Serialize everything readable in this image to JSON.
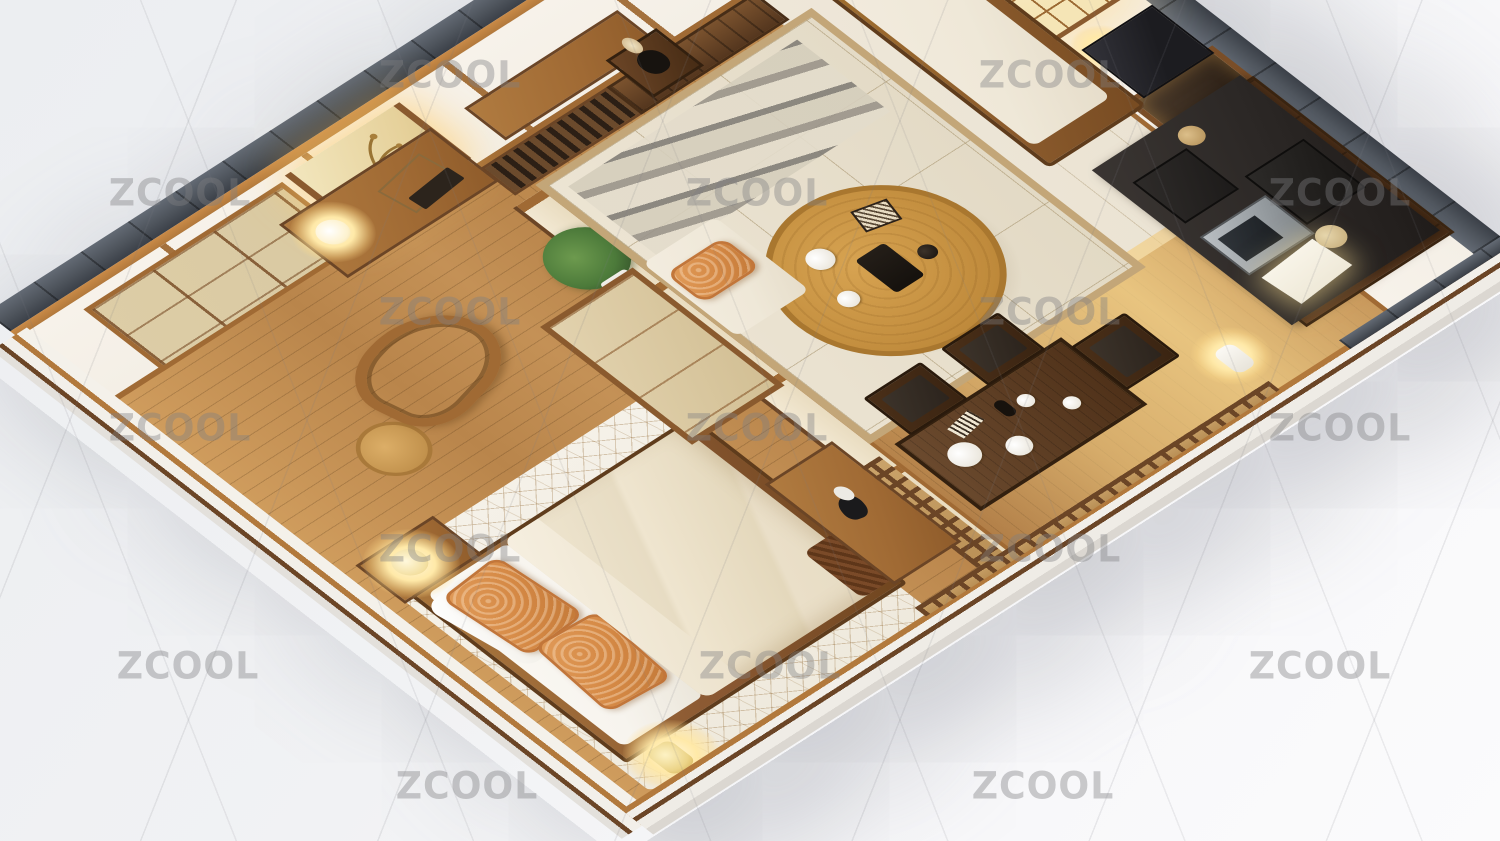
{
  "image": {
    "subject": "3d-isometric-dollhouse-render-of-japanese-style-apartment",
    "view": "cutaway top-down isometric, roof removed, white studio backdrop"
  },
  "watermark": {
    "text": "ZCOOL",
    "color": "rgba(128,128,131,0.40)",
    "positions": [
      [
        450,
        75
      ],
      [
        1050,
        75
      ],
      [
        180,
        193
      ],
      [
        757,
        193
      ],
      [
        1340,
        193
      ],
      [
        450,
        312
      ],
      [
        1050,
        312
      ],
      [
        180,
        428
      ],
      [
        757,
        428
      ],
      [
        1340,
        428
      ],
      [
        450,
        549
      ],
      [
        1050,
        549
      ],
      [
        188,
        666
      ],
      [
        770,
        666
      ],
      [
        1320,
        666
      ],
      [
        467,
        786
      ],
      [
        1043,
        786
      ]
    ]
  },
  "palette": {
    "slate": "#4e545c",
    "slate-dark": "#3b4048",
    "slate-light": "#636a74",
    "wood-cap": "#b2793c",
    "wood-frame": "#a06a34",
    "wood-dark": "#6b4526",
    "wood-deep": "#54361e",
    "walnut": "#4f3119",
    "wood-floor-light": "#cf9c5d",
    "wood-floor": "#b9854b",
    "wood-floor-dark": "#8a5f36",
    "shoji": "#f4efe6",
    "shoji-warm": "#e9dcc0",
    "shoji-tan": "#d9c9a2",
    "tatami": "#e9e1d0",
    "tatami-border": "#c3a678",
    "cream": "#efe8d8",
    "white-soft": "#f7f4ee",
    "duvet": "#eadfc8",
    "pillow-orange": "#d58945",
    "counter-top": "#2c2826",
    "appliance-black": "#1d1b1a",
    "appliance-silver": "#9aa0a4",
    "glow": "#ffe9a8",
    "glow-core": "#fff6d9",
    "green": "#4c7a3a",
    "watermark": "rgba(128,128,131,0.40)"
  },
  "scene": {
    "rooms": [
      {
        "name": "bedroom",
        "items": [
          "double-bed",
          "white-sheets",
          "cream-duvet",
          "two-orange-textured-pillows",
          "crackle-pattern-rug",
          "nightstand-with-glowing-lamp",
          "round-wood-stool",
          "curved-valet-chair",
          "foot-bench-with-bird-figurine",
          "brown-blanket",
          "yellow-floor-lamp"
        ]
      },
      {
        "name": "study-nook",
        "items": [
          "hanging-scroll-painting",
          "console-table",
          "glowing-ball-lamp",
          "books",
          "shoji-closet-doors"
        ]
      },
      {
        "name": "entry",
        "items": [
          "slatted-wood-partition",
          "plank-partition",
          "low-bench",
          "vase-stand-with-dried-branch",
          "console-with-white-towels",
          "two-pendant-lanterns",
          "dark-wall-clock",
          "potted-green-plant"
        ]
      },
      {
        "name": "living",
        "items": [
          "tatami-platform",
          "gray-striped-runner",
          "round-wood-tea-table",
          "tea-tray-and-dishes",
          "floor-cushion-with-orange-bolster",
          "wood-frame-daybed-sofa",
          "beige-pillow",
          "shoji-window-glowing"
        ]
      },
      {
        "name": "kitchen",
        "items": [
          "dark-top-wood-counter",
          "microwave",
          "black-coffee-machine",
          "black-storage-boxes",
          "paper-sheet",
          "round-plate",
          "black-mini-fridge",
          "dark-display-cabinet"
        ]
      },
      {
        "name": "dining",
        "items": [
          "dark-walnut-long-table",
          "tea-set-white-cups-plates-bottle",
          "three-dark-wood-chairs",
          "white-floor-lamp",
          "sunlit-floor-streak"
        ]
      }
    ]
  }
}
